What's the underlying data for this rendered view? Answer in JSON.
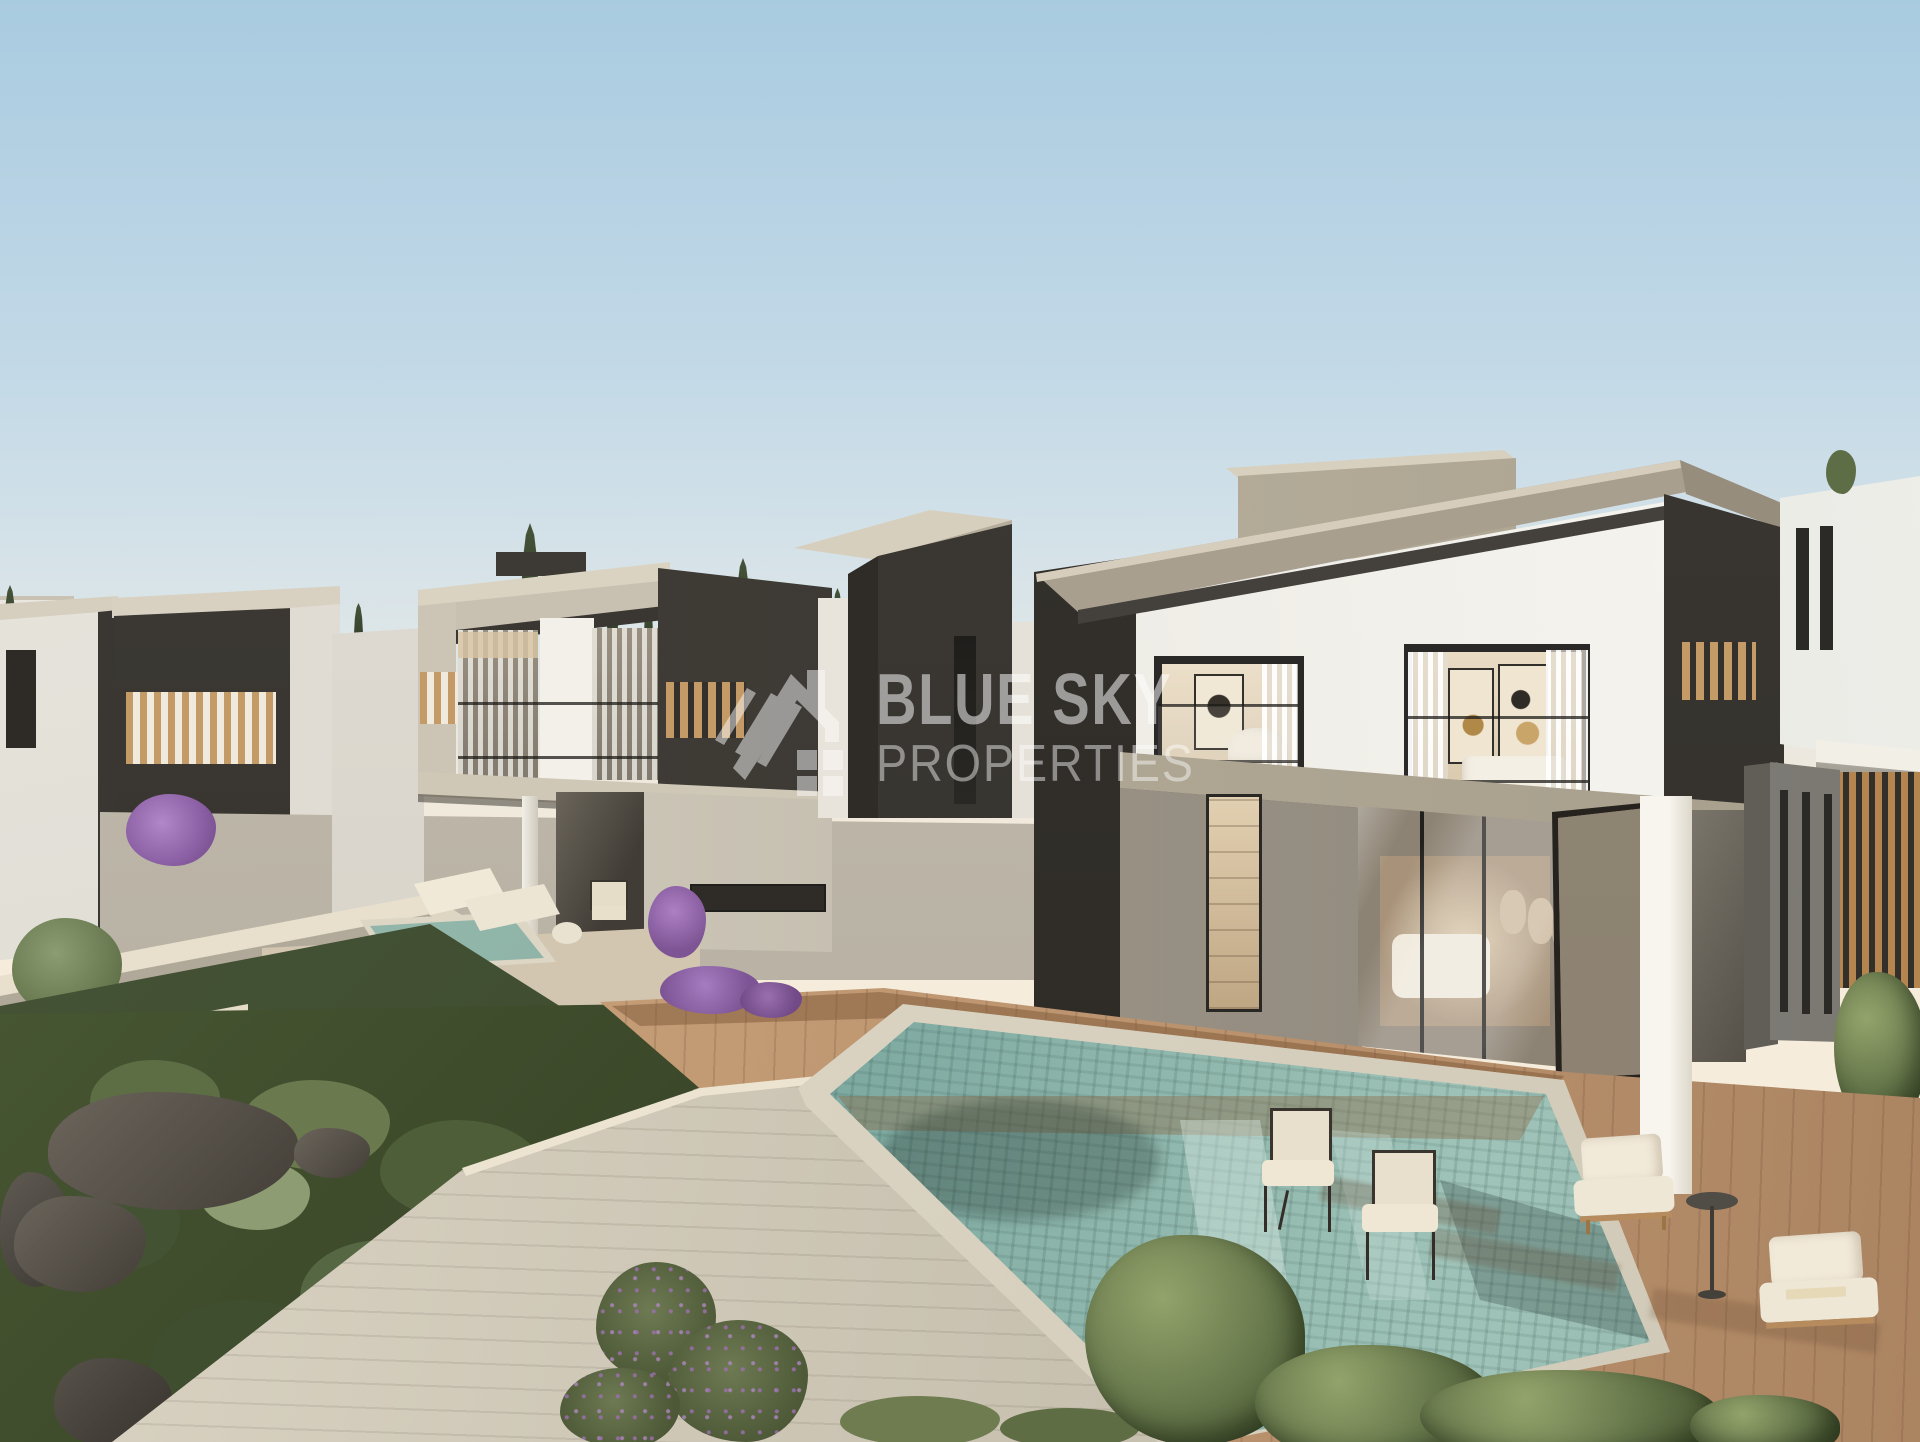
{
  "watermark": {
    "logo_icon": "house-roof-logo-icon",
    "title": "BLUE SKY",
    "subtitle": "PROPERTIES",
    "text_color": "#ffffff",
    "opacity": 0.5
  },
  "palette": {
    "sky_top": "#a9cbe0",
    "sky_soft": "#dde6e8",
    "horizon": "#f6ecdb",
    "charcoal": "#3b3834",
    "charcoal_deep": "#2c2925",
    "white_wall": "#f3f1ec",
    "concrete_frame": "#a89f8f",
    "concrete_light": "#d8d0be",
    "wood_slat": "#c49a66",
    "deck_wood": "#c29a74",
    "pool_deep": "#55827c",
    "pool_light": "#9fc3b8",
    "stone_coping": "#ddd6c4",
    "green_dark": "#3a4729",
    "green_mid": "#5d6e45",
    "green_sage": "#8d9c72",
    "flower_purple": "#9b6fae",
    "rock_gray": "#55504a",
    "hill_brown": "#9a7355",
    "interior_warm": "#e2d0b2"
  }
}
